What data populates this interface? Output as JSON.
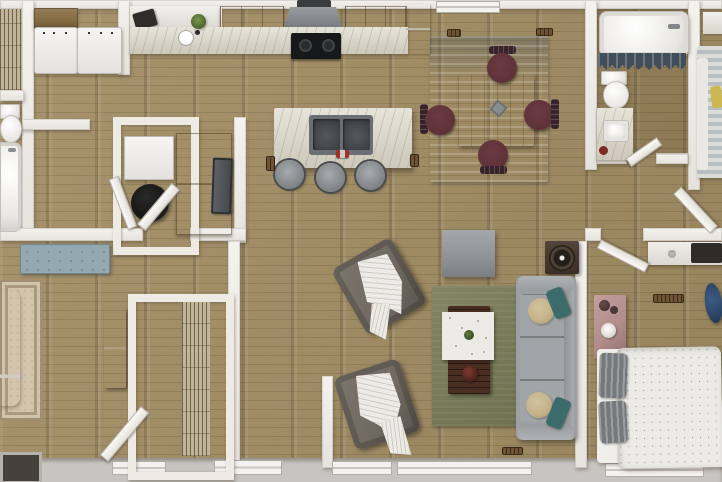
{
  "meta": {
    "title": "3D rendered top-down floor plan",
    "view": "top-down dollhouse render",
    "canvas": {
      "width": 722,
      "height": 482
    }
  },
  "colors": {
    "floor": "#a28d63",
    "wall": "#e6e3dd",
    "marble": "#d9d5c6",
    "cabinet": "#82693f",
    "hood": "#7b7e82",
    "cooktop": "#17181a",
    "applianceWhite": "#f3f2f0",
    "rugBlue": "#8fb0c4",
    "rugBlueDark": "#6f96ad",
    "tableWood": "#c29258",
    "chairMaroon": "#5e3138",
    "chairBackWood": "#38232a",
    "rugGreen": "#777b56",
    "sofaGray": "#9da0a2",
    "pillowTeal": "#3c6b6b",
    "pillowTan": "#c3b188",
    "armchairGray": "#6f6961",
    "throwWhite": "#edebe6",
    "rugBeige": "#d3c5ac",
    "benchBlue": "#94a8b1",
    "dresserDark": "#543634",
    "duvetWhite": "#ebeae5",
    "pillowGray": "#76797b",
    "nightstandMauve": "#b18e8c",
    "deskDark": "#2e2b29",
    "chairNavy": "#2c4566",
    "bedStripe": "#b9bec2",
    "pillowYellow": "#cdb752",
    "curtainSlate": "#414e5a",
    "porch": "#c7c5bf",
    "vent": "#6e5232",
    "waterHeater": "#121110",
    "speaker": "#241e19",
    "glassDark": "#44403a"
  },
  "rooms": [
    {
      "name": "kitchen",
      "furniture": [
        "upper cabinets",
        "range hood",
        "cooktop",
        "marble counter",
        "prep sink",
        "plant",
        "island with double sink",
        "3 bar stools",
        "floor vents"
      ]
    },
    {
      "name": "laundry-nook",
      "furniture": [
        "washer",
        "dryer",
        "cabinet counter"
      ]
    },
    {
      "name": "dining-area",
      "furniture": [
        "blue area rug",
        "square wood table",
        "4 maroon chairs",
        "centerpiece"
      ]
    },
    {
      "name": "living-room",
      "furniture": [
        "gray sofa",
        "2 armchairs with throws",
        "coffee table with marble top",
        "tv console",
        "side table with speaker",
        "green area rug"
      ]
    },
    {
      "name": "primary-bedroom",
      "furniture": [
        "bed",
        "ornate beige rug",
        "tufted bench",
        "dark dresser",
        "walk-in closet with wire shelving"
      ]
    },
    {
      "name": "bathroom-1",
      "furniture": [
        "toilet",
        "bathtub"
      ]
    },
    {
      "name": "bathroom-2",
      "furniture": [
        "bathtub",
        "slate shower curtain",
        "toilet",
        "marble vanity with sink"
      ]
    },
    {
      "name": "bedroom-2",
      "furniture": [
        "bed with striped bedding",
        "yellow pillow",
        "white dresser"
      ]
    },
    {
      "name": "bedroom-3",
      "furniture": [
        "bed with dotted duvet",
        "2 gray striped pillows",
        "mauve nightstand with lamp",
        "desk with monitor",
        "navy chair"
      ]
    },
    {
      "name": "utility-closet",
      "furniture": [
        "water heater",
        "white cabinet"
      ]
    },
    {
      "name": "hallway",
      "furniture": [
        "console desk",
        "dark panel"
      ]
    }
  ]
}
